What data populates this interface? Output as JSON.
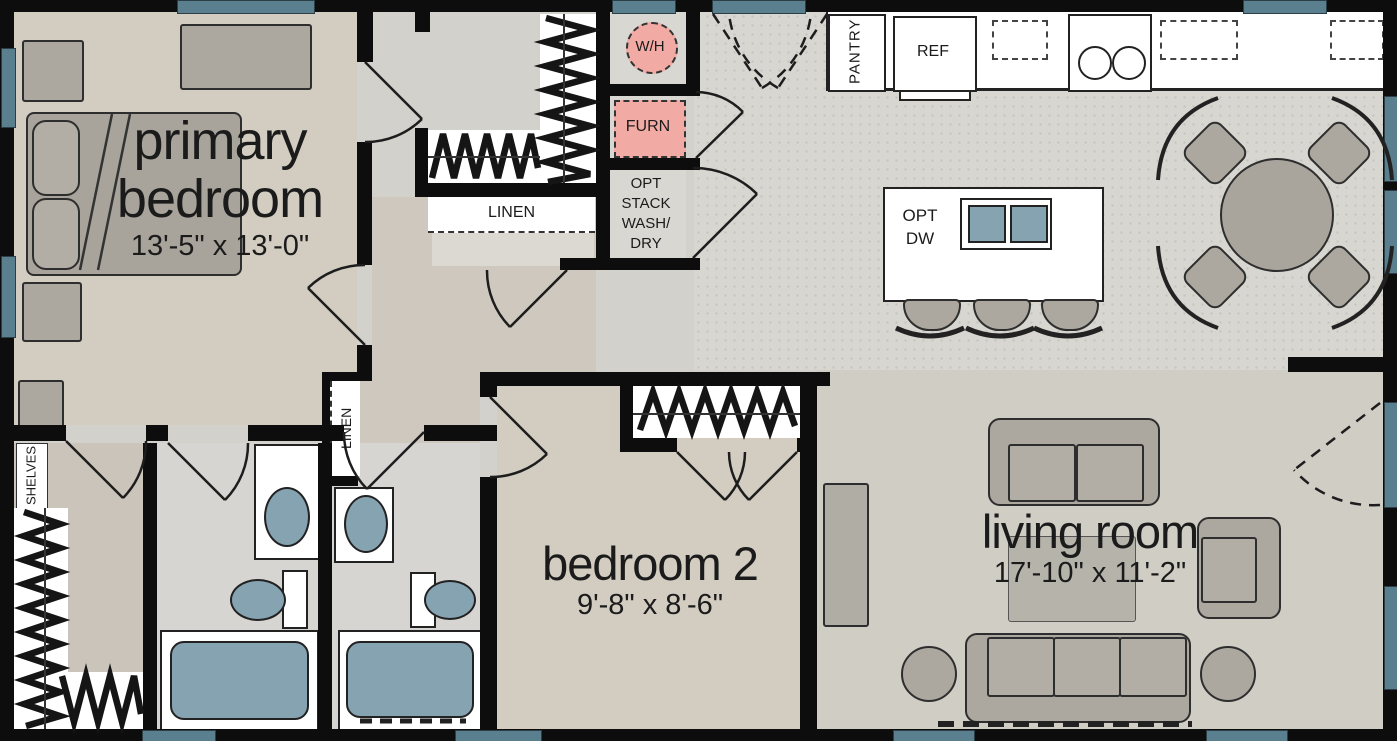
{
  "rooms": {
    "primary_bedroom": {
      "line1": "primary",
      "line2": "bedroom",
      "dims": "13'-5\" x 13'-0\""
    },
    "bedroom2": {
      "name": "bedroom 2",
      "dims": "9'-8\" x 8'-6\""
    },
    "living_room": {
      "name": "living room",
      "dims": "17'-10\" x 11'-2\""
    }
  },
  "closets": {
    "linen_hall": "LINEN",
    "linen_bath": "LINEN",
    "shelves": "SHELVES",
    "pantry": "PANTRY"
  },
  "utility": {
    "water_heater": "W/H",
    "furnace": "FURN",
    "opt_stack": [
      "OPT",
      "STACK",
      "WASH/",
      "DRY"
    ]
  },
  "kitchen": {
    "refrigerator": "REF",
    "opt_dw": [
      "OPT",
      "DW"
    ]
  },
  "colors": {
    "wall": "#0d0d0d",
    "window": "#5a7f8f",
    "utility_pink": "#f2aaa4",
    "fixture_blue": "#86a3b1",
    "floor": "#d3d1cb",
    "furniture": "#aca89f"
  }
}
